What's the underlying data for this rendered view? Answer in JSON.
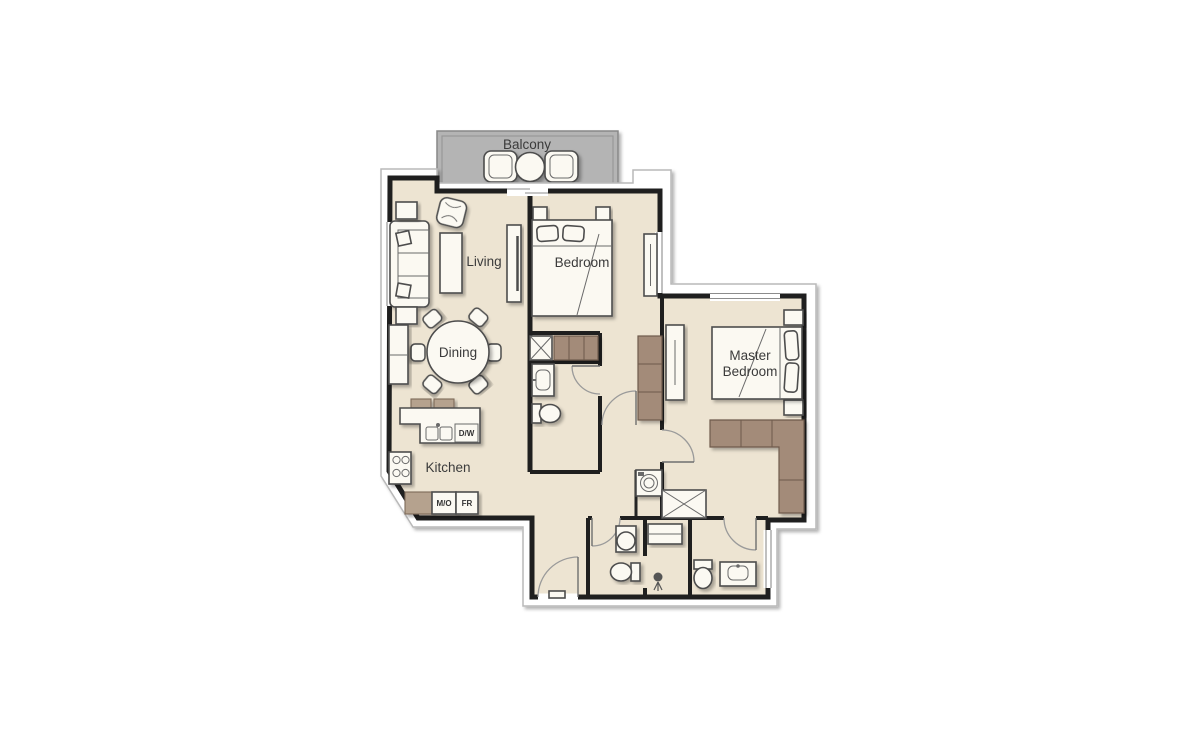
{
  "plan": {
    "rooms": {
      "balcony": {
        "label": "Balcony"
      },
      "living": {
        "label": "Living"
      },
      "dining": {
        "label": "Dining"
      },
      "kitchen": {
        "label": "Kitchen"
      },
      "bedroom": {
        "label": "Bedroom"
      },
      "master_bedroom": {
        "label_line1": "Master",
        "label_line2": "Bedroom"
      }
    },
    "appliances": {
      "dishwasher": "D/W",
      "microwave_oven": "M/O",
      "fridge": "FR"
    },
    "icons": {
      "shaft_icon": "crossed-box duct shaft",
      "washing_machine_icon": "circle-in-square appliance",
      "shower_icon": "shower head",
      "stove_icon": "four-burner hob"
    },
    "colors": {
      "background": "#ffffff",
      "floor": "#ede4d2",
      "balcony": "#b4b4b4",
      "wall": "#1f1f1f",
      "wardrobe_brown": "#a38b79",
      "counter_brown": "#b5a28e",
      "furniture_white": "#fbf9f2",
      "label_text": "#3b3b3b"
    }
  }
}
